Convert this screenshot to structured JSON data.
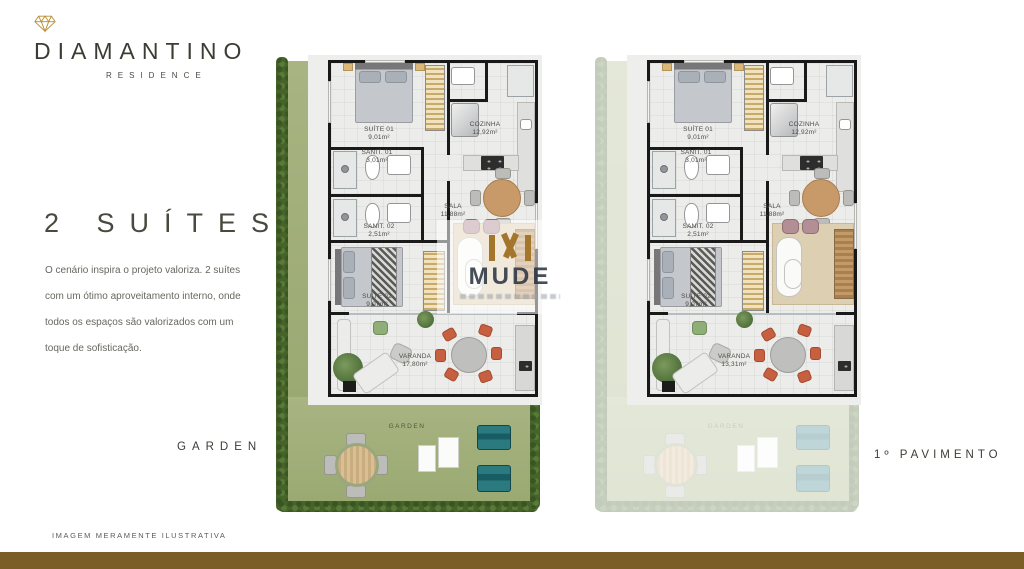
{
  "brand": {
    "title": "DIAMANTINO",
    "subtitle": "RESIDENCE"
  },
  "headline": "2 SUÍTES",
  "description_lines": [
    "O cenário inspira o projeto valoriza. 2 suítes",
    "com um ótimo aproveitamento interno, onde",
    "todos os espaços são valorizados com um",
    "toque de sofisticação."
  ],
  "plan_captions": {
    "left": "GARDEN",
    "right": "1º PAVIMENTO"
  },
  "disclaimer": "IMAGEM MERAMENTE ILUSTRATIVA",
  "watermark": {
    "name": "MUDE"
  },
  "plans": [
    {
      "caption": "GARDEN",
      "garden_label": "GARDEN",
      "rooms": {
        "suite1": {
          "label": "SUÍTE 01",
          "area": "9,01m²"
        },
        "sanit1": {
          "label": "SANIT. 01",
          "area": "3,01m²"
        },
        "sanit2": {
          "label": "SANIT. 02",
          "area": "2,51m²"
        },
        "cozinha": {
          "label": "COZINHA",
          "area": "12,92m²"
        },
        "sala": {
          "label": "SALA",
          "area": "11,88m²"
        },
        "suite2": {
          "label": "SUÍTE 02",
          "area": "9,07m²"
        },
        "varanda": {
          "label": "VARANDA",
          "area": "17,80m²"
        }
      }
    },
    {
      "caption": "1º PAVIMENTO",
      "garden_label": "GARDEN",
      "rooms": {
        "suite1": {
          "label": "SUÍTE 01",
          "area": "9,01m²"
        },
        "sanit1": {
          "label": "SANIT. 01",
          "area": "3,01m²"
        },
        "sanit2": {
          "label": "SANIT. 02",
          "area": "2,51m²"
        },
        "cozinha": {
          "label": "COZINHA",
          "area": "12,92m²"
        },
        "sala": {
          "label": "SALA",
          "area": "11,88m²"
        },
        "suite2": {
          "label": "SUÍTE 02",
          "area": "9,07m²"
        },
        "varanda": {
          "label": "VARANDA",
          "area": "13,31m²"
        }
      }
    }
  ],
  "colors": {
    "accent_gold": "#a4762c",
    "bottom_bar": "#7b5d26",
    "grass": "#a3b07c",
    "hedge": "#466428",
    "teal_lounger": "#1f6b72",
    "salmon_chair": "#c75f41"
  }
}
